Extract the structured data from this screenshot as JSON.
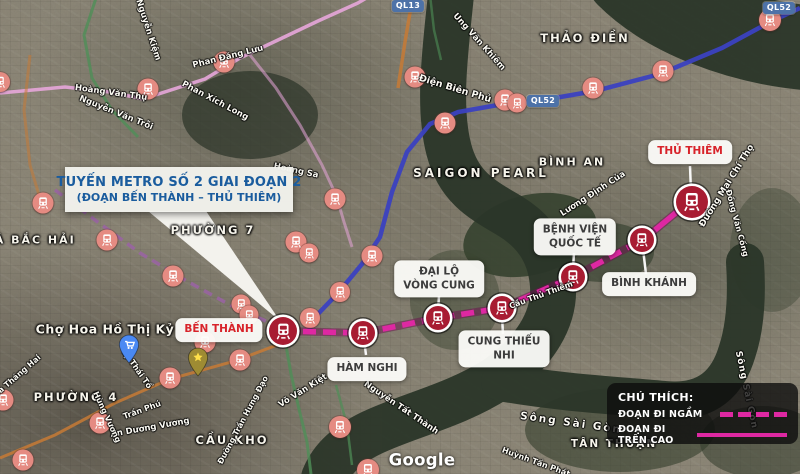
{
  "title_box": {
    "line1": "TUYẾN METRO SỐ 2 GIAI ĐOẠN 2",
    "line2": "(ĐOẠN BẾN THÀNH – THỦ THIÊM)"
  },
  "legend": {
    "title": "CHÚ THÍCH:",
    "items": [
      {
        "label": "ĐOẠN ĐI NGẦM",
        "style": "dashed"
      },
      {
        "label": "ĐOẠN ĐI TRÊN CAO",
        "style": "solid"
      }
    ]
  },
  "watermark": {
    "text": "Google"
  },
  "colors": {
    "route": "#de28a2",
    "route_outline": "#6b0f4e",
    "station_fill": "#a81c32",
    "transit_marker": "#e58b82",
    "title_text": "#1a5c9e",
    "station_label_red": "#d8232a",
    "road_blue": "#3b41c0",
    "road_pink": "#e7a6da",
    "road_purple": "#9a63a4",
    "road_green": "#4f8f57",
    "road_orange": "#c77a35",
    "water": "#2b3629",
    "shield_bg": "#4d72a8"
  },
  "route": {
    "underground_points": [
      [
        283,
        331
      ],
      [
        363,
        333
      ],
      [
        438,
        318
      ],
      [
        502,
        308
      ],
      [
        573,
        277
      ],
      [
        642,
        240
      ],
      [
        655,
        230
      ]
    ],
    "elevated_points": [
      [
        655,
        230
      ],
      [
        672,
        216
      ],
      [
        684,
        206
      ],
      [
        692,
        202
      ]
    ]
  },
  "stations": [
    {
      "name": "BẾN THÀNH",
      "x": 283,
      "y": 331,
      "d": 28,
      "label": {
        "lines": [
          "BẾN THÀNH"
        ],
        "x": 219,
        "y": 330,
        "color": "red"
      },
      "pointer": null
    },
    {
      "name": "HÀM NGHI",
      "x": 363,
      "y": 333,
      "d": 24,
      "label": {
        "lines": [
          "HÀM NGHI"
        ],
        "x": 367,
        "y": 369,
        "color": "dark"
      },
      "pointer": [
        364,
        339,
        366,
        355
      ]
    },
    {
      "name": "ĐẠI LỘ VÒNG CUNG",
      "x": 438,
      "y": 318,
      "d": 24,
      "label": {
        "lines": [
          "ĐẠI LỘ",
          "VÒNG CUNG"
        ],
        "x": 439,
        "y": 279,
        "color": "dark"
      },
      "pointer": [
        439,
        296,
        438,
        311
      ]
    },
    {
      "name": "CUNG THIẾU NHI",
      "x": 502,
      "y": 308,
      "d": 24,
      "label": {
        "lines": [
          "CUNG THIẾU",
          "NHI"
        ],
        "x": 504,
        "y": 349,
        "color": "dark"
      },
      "pointer": [
        503,
        334,
        502,
        316
      ]
    },
    {
      "name": "BỆNH VIỆN QUỐC TẾ",
      "x": 573,
      "y": 277,
      "d": 24,
      "label": {
        "lines": [
          "BỆNH VIỆN",
          "QUỐC TẾ"
        ],
        "x": 575,
        "y": 237,
        "color": "dark"
      },
      "pointer": [
        574,
        253,
        573,
        269
      ]
    },
    {
      "name": "BÌNH KHÁNH",
      "x": 642,
      "y": 240,
      "d": 24,
      "label": {
        "lines": [
          "BÌNH KHÁNH"
        ],
        "x": 649,
        "y": 284,
        "color": "dark"
      },
      "pointer": [
        646,
        274,
        643,
        249
      ]
    },
    {
      "name": "THỦ THIÊM",
      "x": 692,
      "y": 202,
      "d": 32,
      "label": {
        "lines": [
          "THỦ THIÊM"
        ],
        "x": 690,
        "y": 152,
        "color": "red"
      },
      "pointer": [
        690,
        166,
        691,
        192
      ]
    }
  ],
  "background_markers": [
    [
      0,
      82,
      20
    ],
    [
      148,
      89,
      21
    ],
    [
      224,
      62,
      21
    ],
    [
      43,
      203,
      21
    ],
    [
      107,
      240,
      21
    ],
    [
      173,
      276,
      21
    ],
    [
      241,
      304,
      19
    ],
    [
      249,
      315,
      19
    ],
    [
      296,
      242,
      21
    ],
    [
      309,
      253,
      19
    ],
    [
      335,
      199,
      21
    ],
    [
      372,
      256,
      21
    ],
    [
      340,
      292,
      20
    ],
    [
      310,
      318,
      20
    ],
    [
      205,
      342,
      21
    ],
    [
      240,
      360,
      21
    ],
    [
      170,
      378,
      21
    ],
    [
      3,
      400,
      21
    ],
    [
      23,
      460,
      21
    ],
    [
      100,
      423,
      21
    ],
    [
      340,
      427,
      22
    ],
    [
      368,
      470,
      22
    ],
    [
      415,
      77,
      21
    ],
    [
      445,
      123,
      21
    ],
    [
      505,
      100,
      21
    ],
    [
      517,
      103,
      19
    ],
    [
      593,
      88,
      21
    ],
    [
      663,
      71,
      21
    ],
    [
      770,
      20,
      22
    ]
  ],
  "map_labels": [
    {
      "text": "THẢO ĐIỀN",
      "x": 585,
      "y": 38,
      "fs": 11.5,
      "ls": 2
    },
    {
      "text": "BÌNH AN",
      "x": 572,
      "y": 162,
      "fs": 11,
      "ls": 2
    },
    {
      "text": "SAIGON PEARL",
      "x": 481,
      "y": 173,
      "fs": 12,
      "ls": 3
    },
    {
      "text": "PHƯỜNG 7",
      "x": 213,
      "y": 230,
      "fs": 11.5,
      "ls": 2
    },
    {
      "text": "XÁ BẮC HẢI",
      "x": 30,
      "y": 240,
      "fs": 11,
      "ls": 2
    },
    {
      "text": "Chợ Hoa Hồ Thị Kỷ",
      "x": 105,
      "y": 329,
      "fs": 12.5,
      "ls": 0.5
    },
    {
      "text": "PHƯỜNG 4",
      "x": 76,
      "y": 397,
      "fs": 11.5,
      "ls": 2
    },
    {
      "text": "CẦU KHO",
      "x": 232,
      "y": 440,
      "fs": 11.5,
      "ls": 2
    },
    {
      "text": "TÂN THUẬN",
      "x": 614,
      "y": 444,
      "fs": 10.5,
      "ls": 2
    }
  ],
  "road_labels": [
    {
      "text": "Hoàng Văn Thụ",
      "x": 111,
      "y": 93,
      "rot": 8,
      "fs": 8.5
    },
    {
      "text": "Nguyễn Văn Trỗi",
      "x": 116,
      "y": 113,
      "rot": 22,
      "fs": 8.5
    },
    {
      "text": "Phan Xích Long",
      "x": 215,
      "y": 101,
      "rot": 28,
      "fs": 8.5
    },
    {
      "text": "Phan Đăng Lưu",
      "x": 228,
      "y": 57,
      "rot": -14,
      "fs": 8.5
    },
    {
      "text": "Nguyễn Kiệm",
      "x": 148,
      "y": 30,
      "rot": 72,
      "fs": 8.5
    },
    {
      "text": "Điện Biên Phủ",
      "x": 455,
      "y": 89,
      "rot": 17,
      "fs": 9.5
    },
    {
      "text": "Ung Văn Khiêm",
      "x": 479,
      "y": 42,
      "rot": 48,
      "fs": 8.5
    },
    {
      "text": "Hoàng Sa",
      "x": 296,
      "y": 171,
      "rot": 12,
      "fs": 8.5
    },
    {
      "text": "Lương Định Của",
      "x": 593,
      "y": 194,
      "rot": -33,
      "fs": 8.5
    },
    {
      "text": "Đường Mai Chí Thọ",
      "x": 727,
      "y": 186,
      "rot": -58,
      "fs": 9
    },
    {
      "text": "Đồng Văn Cống",
      "x": 737,
      "y": 223,
      "rot": 75,
      "fs": 8
    },
    {
      "text": "Sông Sài Gòn",
      "x": 571,
      "y": 423,
      "rot": 8,
      "fs": 10.5,
      "ls": 2
    },
    {
      "text": "Sông Sài Gòn",
      "x": 746,
      "y": 390,
      "rot": 78,
      "fs": 9,
      "ls": 1
    },
    {
      "text": "Võ Văn Kiệt",
      "x": 303,
      "y": 391,
      "rot": -32,
      "fs": 8.5
    },
    {
      "text": "Nguyễn Tất Thành",
      "x": 401,
      "y": 408,
      "rot": 34,
      "fs": 8.5
    },
    {
      "text": "Lý Thái Tổ",
      "x": 137,
      "y": 369,
      "rot": 55,
      "fs": 8
    },
    {
      "text": "An Dương Vương",
      "x": 150,
      "y": 428,
      "rot": -10,
      "fs": 8.5
    },
    {
      "text": "Trần Phú",
      "x": 142,
      "y": 410,
      "rot": -20,
      "fs": 8
    },
    {
      "text": "Hùng Vương",
      "x": 107,
      "y": 417,
      "rot": 65,
      "fs": 8
    },
    {
      "text": "Đường Trần Hưng Đạo",
      "x": 243,
      "y": 420,
      "rot": -62,
      "fs": 8
    },
    {
      "text": "Ba Tháng Hai",
      "x": 17,
      "y": 376,
      "rot": -41,
      "fs": 8
    },
    {
      "text": "Huỳnh Tấn Phát",
      "x": 536,
      "y": 462,
      "rot": 20,
      "fs": 8
    },
    {
      "text": "Cầu Thủ Thiêm",
      "x": 541,
      "y": 295,
      "rot": -20,
      "fs": 8
    }
  ],
  "road_shields": [
    {
      "text": "QL13",
      "x": 408,
      "y": 6
    },
    {
      "text": "QL52",
      "x": 543,
      "y": 101
    },
    {
      "text": "QL52",
      "x": 779,
      "y": 8
    }
  ],
  "poi_pins": [
    {
      "type": "star-pin",
      "x": 198,
      "y": 364
    },
    {
      "type": "market-pin",
      "x": 129,
      "y": 351
    }
  ]
}
